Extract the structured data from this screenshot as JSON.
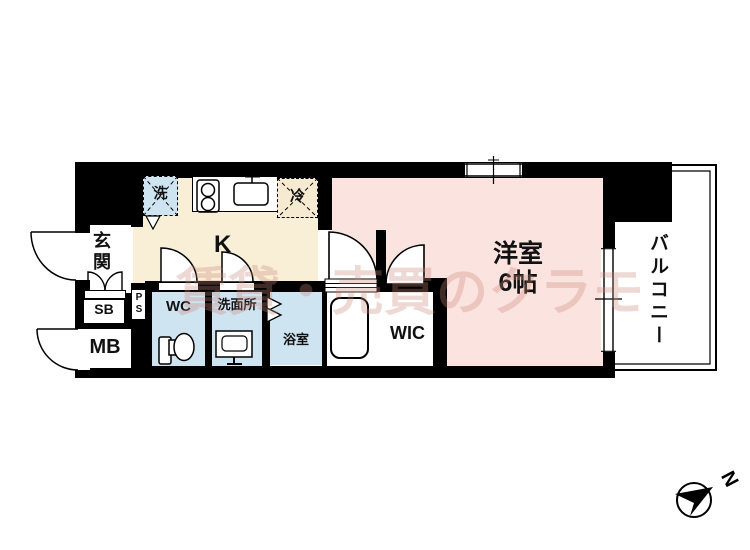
{
  "watermark": "賃貸・売買のクラモ",
  "labels": {
    "entrance": "玄関",
    "kitchen": "K",
    "washer": "洗",
    "fridge": "冷",
    "western_room": "洋室",
    "western_room_size": "6帖",
    "balcony": "バルコニー",
    "wic": "WIC",
    "toilet": "WC",
    "washroom": "洗面所",
    "bathroom": "浴室",
    "shoe_box": "SB",
    "pipe_space": "PS",
    "meter_box": "MB",
    "compass_north": "N"
  },
  "colors": {
    "wall": "#000000",
    "kitchen_floor": "#f8efd6",
    "room_floor": "#fbe3df",
    "wet_area_floor": "#cfe4f1",
    "fridge_fill": "#f6ead0",
    "washer_fill": "#cfe4f1",
    "watermark": "#c98678"
  }
}
